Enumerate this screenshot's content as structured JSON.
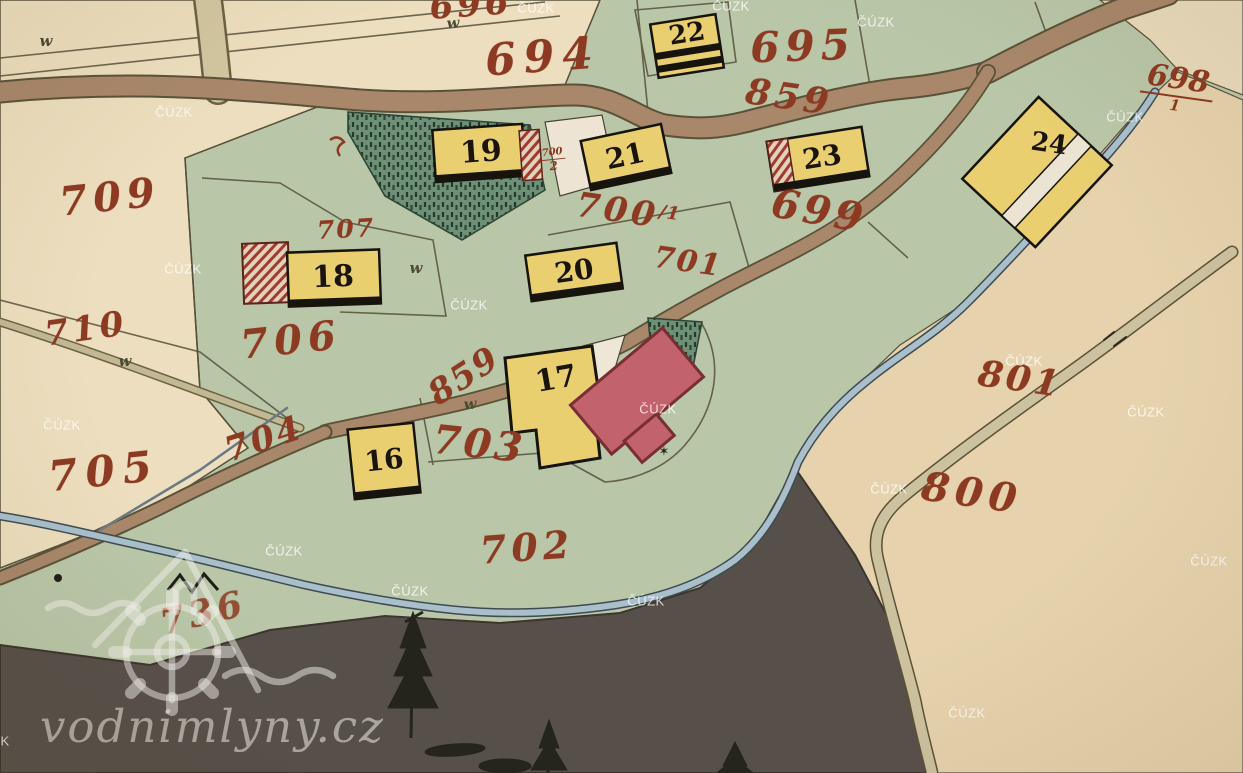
{
  "watermarks": {
    "agency": "ČÚZK",
    "site": "vodnimlyny.cz"
  },
  "parcel_numbers": {
    "n696": "696",
    "n694": "694",
    "n695": "695",
    "n859_top": "859",
    "n698": "698",
    "n698_den": "1",
    "n699": "699",
    "n700": "700",
    "n700_sup": "/1",
    "n700_2_num": "700",
    "n700_2_den": "2",
    "n701": "701",
    "n707": "707",
    "n709": "709",
    "n710": "710",
    "n706": "706",
    "n705": "705",
    "n704": "704",
    "n703": "703",
    "n702": "702",
    "n736": "736",
    "n800": "800",
    "n801": "801",
    "n859_mid": "859"
  },
  "building_numbers": {
    "b16": "16",
    "b17": "17",
    "b18": "18",
    "b19": "19",
    "b20": "20",
    "b21": "21",
    "b22": "22",
    "b23": "23",
    "b24": "24"
  },
  "symbols": {
    "meadow": "w",
    "star": "✶"
  },
  "colors": {
    "parchment": "#ecdebe",
    "field_green": "#b9c7a8",
    "pond_dark": "#57504a",
    "road_brown": "#a8876b",
    "stream_blue": "#a9c0cb",
    "ink_red": "#8d3a22",
    "ink_black": "#1a140d",
    "building_yellow": "#e9cf6f",
    "building_red": "#c2626c"
  }
}
